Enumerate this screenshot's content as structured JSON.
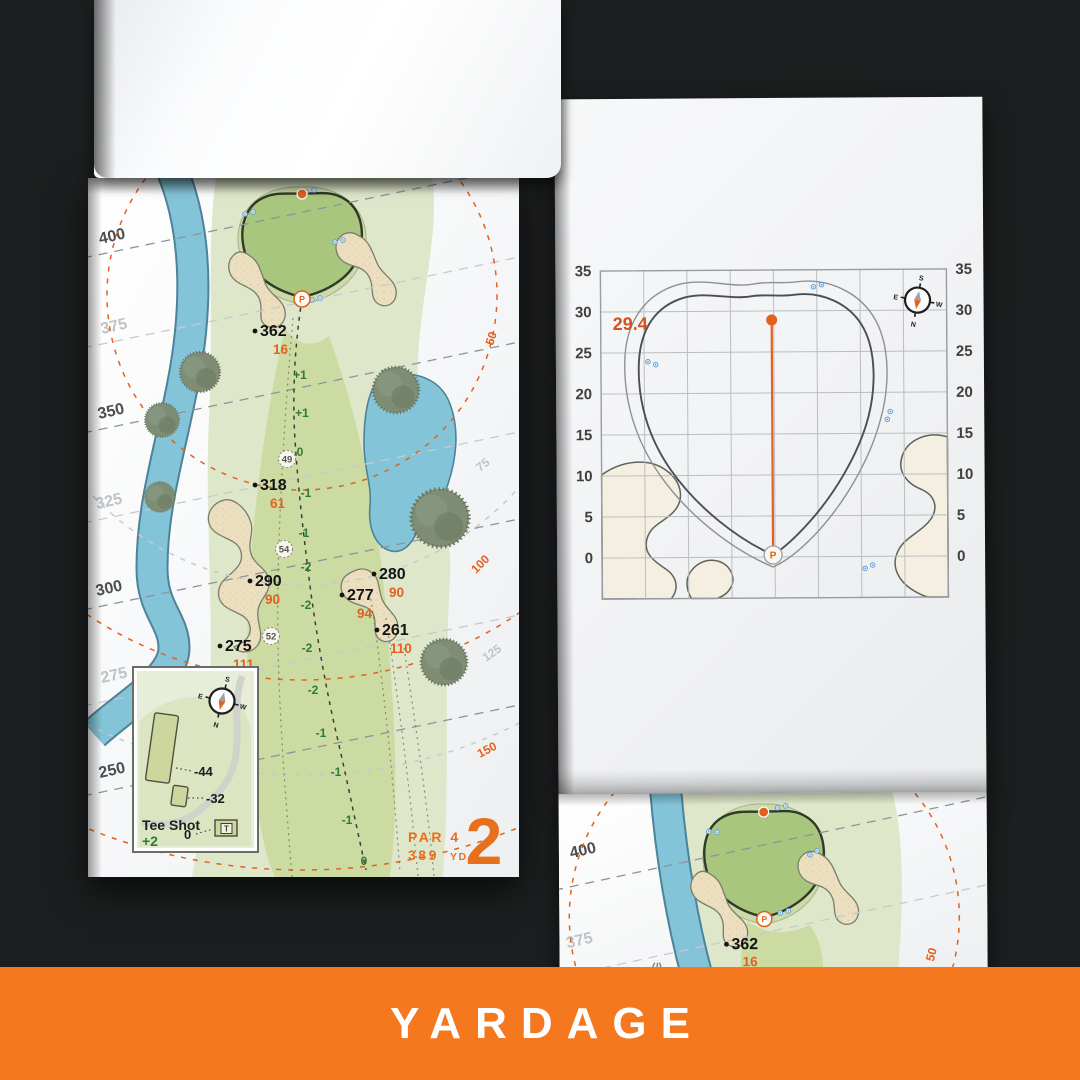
{
  "banner": {
    "title": "YARDAGE"
  },
  "colors": {
    "banner_orange": "#f5771e",
    "accent_orange": "#e2611f",
    "hole_orange": "#e8701d",
    "elevation_green": "#2e7b35",
    "water_blue": "#84c4d8",
    "sand": "#ecdfc0",
    "putting_green": "#a9c67f",
    "fairway": "#ccdba2",
    "rough": "#dfe7cb"
  },
  "left_page": {
    "contour_labels": [
      "400",
      "375",
      "350",
      "325",
      "300",
      "275",
      "250"
    ],
    "arc_labels": [
      "50",
      "75",
      "100",
      "125",
      "150"
    ],
    "yardage_points": [
      {
        "carry": "362",
        "remaining": "16"
      },
      {
        "carry": "318",
        "remaining": "61"
      },
      {
        "carry": "290",
        "remaining": "90"
      },
      {
        "carry": "280",
        "remaining": "90"
      },
      {
        "carry": "277",
        "remaining": "94"
      },
      {
        "carry": "261",
        "remaining": "110"
      },
      {
        "carry": "275",
        "remaining": "111"
      }
    ],
    "centerline_elevations": [
      "+1",
      "+1",
      "0",
      "-1",
      "-1",
      "-2",
      "-2",
      "-2",
      "-2",
      "-1",
      "-1",
      "-1",
      "0"
    ],
    "circled_distances": [
      "49",
      "54",
      "52"
    ],
    "pin_marker": "P",
    "inset": {
      "title": "Tee Shot",
      "handicap": "+2",
      "carry_left": "-44",
      "carry_right": "-32",
      "tee_zero": "0",
      "tee_letter": "T"
    },
    "hole": {
      "par": "PAR 4",
      "yards": "389",
      "unit": "YD",
      "number": "2"
    },
    "compass": {
      "n": "N",
      "s": "S",
      "e": "E",
      "w": "W"
    }
  },
  "green_page": {
    "pin_depth": "29.4",
    "tick_labels": [
      "35",
      "30",
      "25",
      "20",
      "15",
      "10",
      "5",
      "0"
    ],
    "pin_marker": "P",
    "compass": {
      "n": "N",
      "s": "S",
      "e": "E",
      "w": "W"
    }
  },
  "next_page": {
    "contour_labels": [
      "400",
      "375"
    ],
    "arc_label": "50",
    "point": {
      "carry": "362",
      "remaining": "16"
    },
    "pin_marker": "P"
  },
  "chart_data": {
    "type": "line",
    "title": "Green depth grid, hole 2",
    "ylabel": "yards from front of green",
    "yticks": [
      0,
      5,
      10,
      15,
      20,
      25,
      30,
      35
    ],
    "grid_step_yards": 5,
    "pin_depth": 29.4,
    "annotations": [
      "29.4"
    ],
    "legend_position": "none"
  }
}
